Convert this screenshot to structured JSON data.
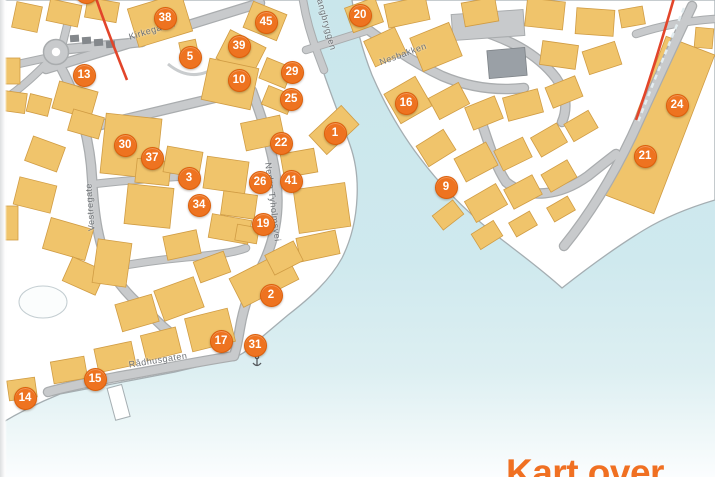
{
  "heading": "Kart over",
  "map": {
    "street_labels": [
      {
        "id": "kirkegaten",
        "text": "Kirkegaten"
      },
      {
        "id": "langbryggen",
        "text": "Langbryggen"
      },
      {
        "id": "nesbakken",
        "text": "Nesbakken"
      },
      {
        "id": "nedre-tyholmsvei",
        "text": "Nedre Tyholmsvei"
      },
      {
        "id": "vestregate",
        "text": "Vestregate"
      },
      {
        "id": "radhusgaten",
        "text": "Rådhusgaten"
      }
    ],
    "markers": [
      {
        "number": "1"
      },
      {
        "number": "2"
      },
      {
        "number": "3"
      },
      {
        "number": "5"
      },
      {
        "number": "9"
      },
      {
        "number": "10"
      },
      {
        "number": "13"
      },
      {
        "number": "14"
      },
      {
        "number": "15"
      },
      {
        "number": "16"
      },
      {
        "number": "17"
      },
      {
        "number": "19"
      },
      {
        "number": "20"
      },
      {
        "number": "21"
      },
      {
        "number": "22"
      },
      {
        "number": "24"
      },
      {
        "number": "25"
      },
      {
        "number": "26"
      },
      {
        "number": "29"
      },
      {
        "number": "30"
      },
      {
        "number": "31"
      },
      {
        "number": "34"
      },
      {
        "number": "37"
      },
      {
        "number": "38"
      },
      {
        "number": "39"
      },
      {
        "number": "41"
      },
      {
        "number": "45"
      },
      {
        "number": ""
      }
    ]
  },
  "colors": {
    "marker": "#ee7320",
    "marker_border": "#dd5f0a",
    "heading": "#f07022",
    "building": "#f0c46b",
    "water": "#cfe9ee",
    "route": "#e2452a",
    "road": "#c8cacc"
  }
}
